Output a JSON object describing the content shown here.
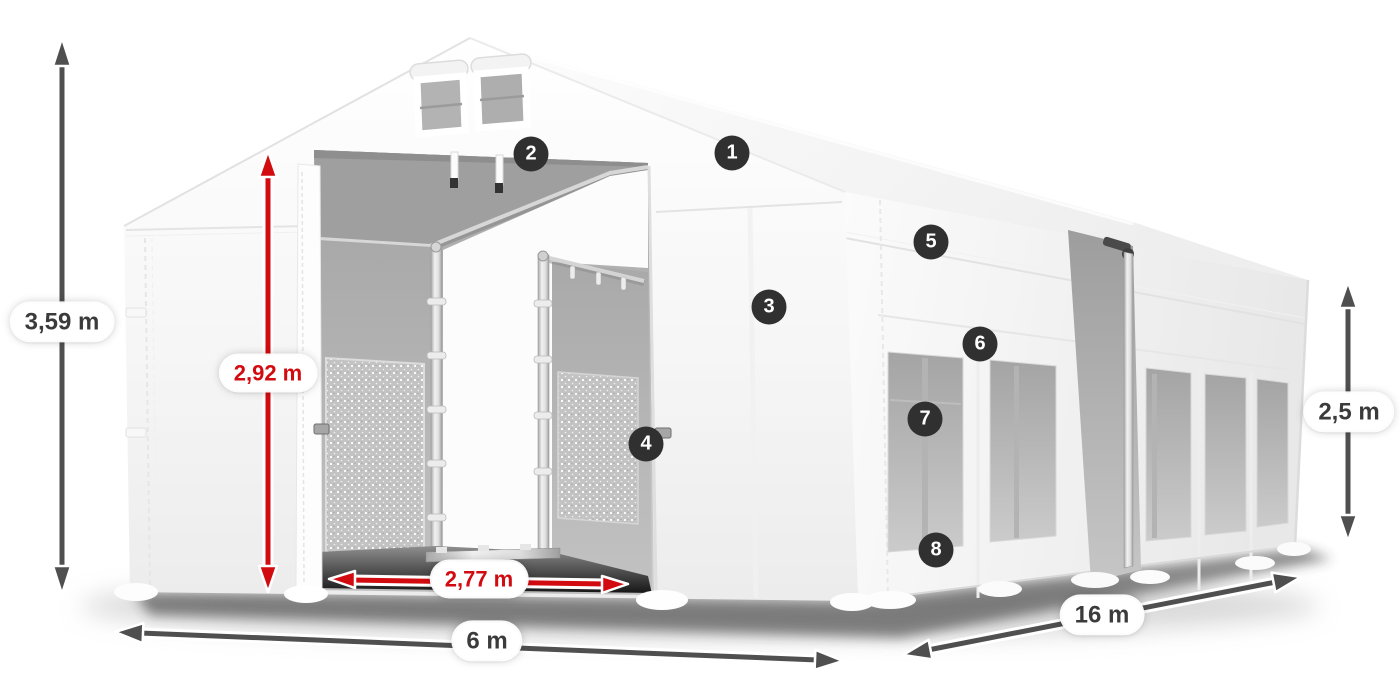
{
  "dimension_labels": {
    "total_height": "3,59 m",
    "entrance_height": "2,92 m",
    "entrance_width": "2,77 m",
    "width": "6 m",
    "length": "16 m",
    "side_height": "2,5 m"
  },
  "feature_markers": [
    "1",
    "2",
    "3",
    "4",
    "5",
    "6",
    "7",
    "8"
  ],
  "colors": {
    "background": "#ffffff",
    "dimension_red": "#d20b10",
    "dimension_gray": "#4f4f4f",
    "label_text_dark": "#3b3b3b",
    "marker_bg": "#303030",
    "marker_text": "#ffffff",
    "tent_white": "#f7f7f7",
    "interior_gray": "#aaaaaa"
  }
}
